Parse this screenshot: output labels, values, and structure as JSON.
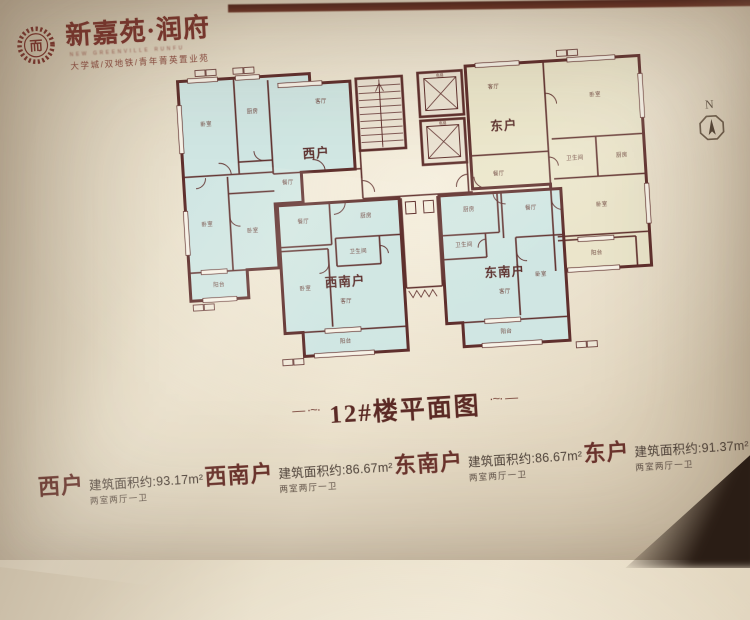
{
  "logo": {
    "name": "新嘉苑·润府",
    "english": "NEW GREENVILLE RUNFU",
    "tagline": "大学城/双地铁/青年菁英置业苑",
    "seal_char": "而"
  },
  "compass": {
    "label": "N"
  },
  "plan": {
    "units": {
      "west": "西户",
      "east": "东户",
      "southwest": "西南户",
      "southeast": "东南户"
    },
    "rooms": {
      "bedroom": "卧室",
      "living": "客厅",
      "dining": "餐厅",
      "kitchen": "厨房",
      "bath": "卫生间",
      "balcony": "阳台",
      "elevator": "电梯"
    }
  },
  "title": {
    "text": "12#楼平面图",
    "ornament_left": "— ·~·",
    "ornament_right": "·~· —"
  },
  "legend": {
    "items": [
      {
        "name": "西户",
        "area": "建筑面积约:93.17m²",
        "layout": "两室两厅一卫"
      },
      {
        "name": "西南户",
        "area": "建筑面积约:86.67m²",
        "layout": "两室两厅一卫"
      },
      {
        "name": "东南户",
        "area": "建筑面积约:86.67m²",
        "layout": "两室两厅一卫"
      },
      {
        "name": "东户",
        "area": "建筑面积约:91.37m²",
        "layout": "两室两厅一卫"
      }
    ]
  },
  "colors": {
    "accent_maroon": "#7c352e",
    "wall": "#5e2927",
    "room_blue": "#cfe7e4",
    "room_yellow": "#ebe6c9",
    "board_beige": "#e6dcc6"
  }
}
